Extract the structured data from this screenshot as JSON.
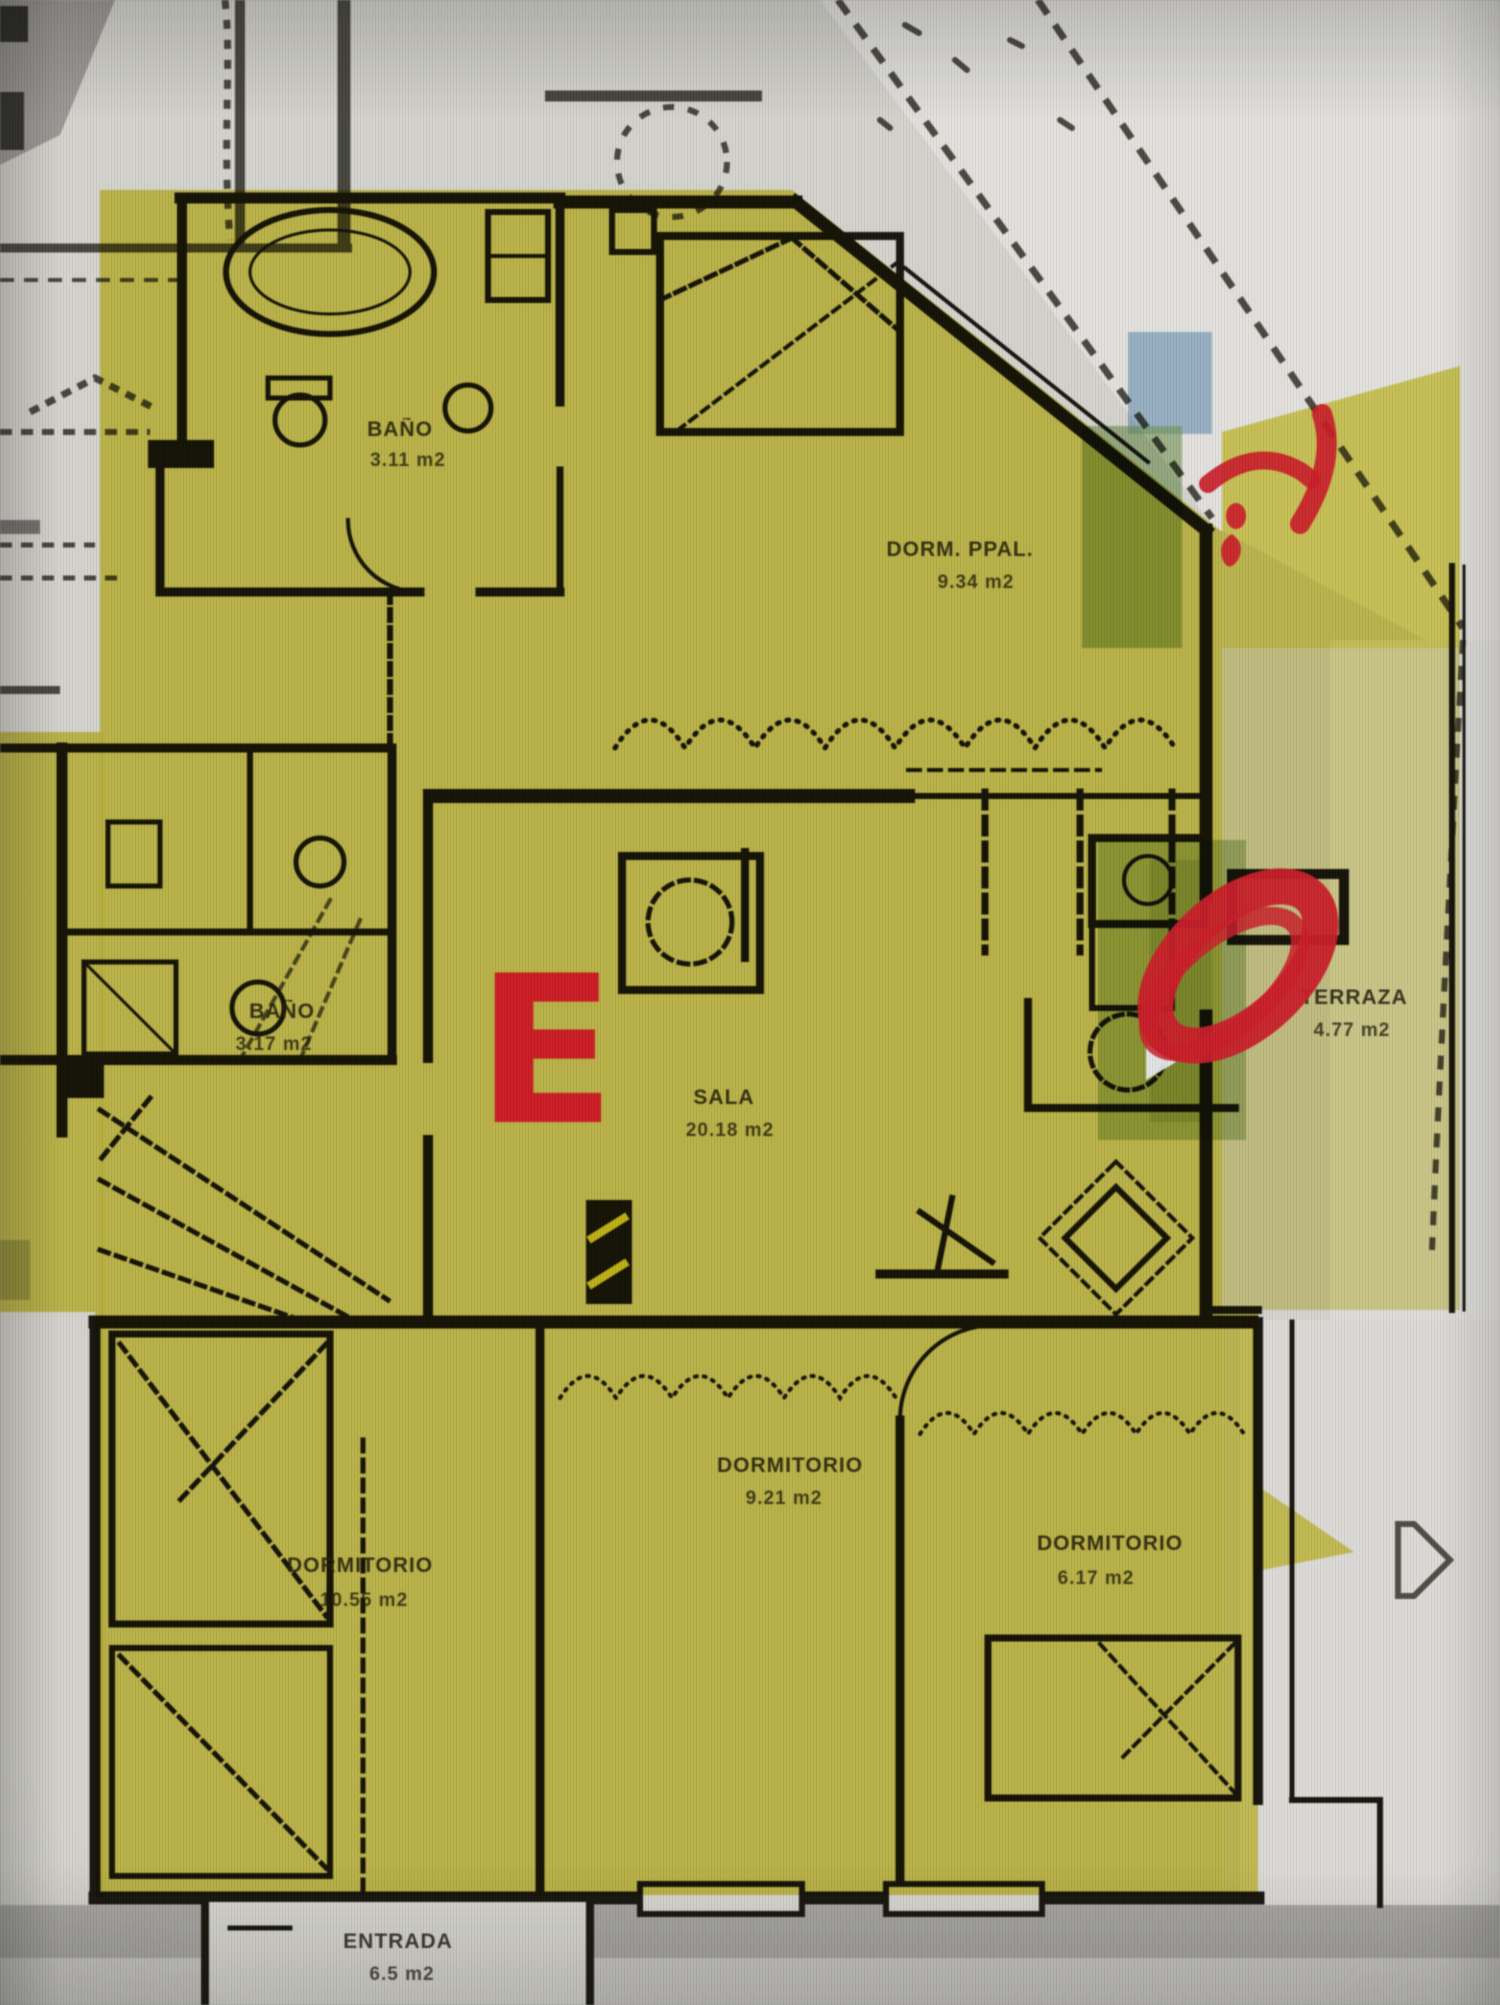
{
  "scene": {
    "description": "Photograph of an apartment floor plan highlighted in yellow marker with red unit letter and red pen annotations",
    "unit_letter": "E"
  },
  "palette": {
    "highlight_yellow": "#d9d24c",
    "terrace_yellow": "#d5cf63",
    "marker_red": "#c2202a",
    "letter_red": "#c41e25",
    "marker_green": "#7da45e",
    "marker_blue": "#7fa9cc",
    "paper": "#d7d6d1",
    "paper_bright": "#e4e3e0",
    "ink": "#17150e",
    "background_gray": "#b0afac"
  },
  "rooms": {
    "dorm_ppal": {
      "name": "DORM. PPAL.",
      "area": "9.34 m2"
    },
    "bano_1": {
      "name": "BAÑO",
      "area": "3.11 m2"
    },
    "bano_2": {
      "name": "BAÑO",
      "area": "3.17 m2"
    },
    "sala": {
      "name": "SALA",
      "area": "20.18 m2"
    },
    "terraza": {
      "name": "TERRAZA",
      "area": "4.77 m2"
    },
    "dormitorio_1": {
      "name": "DORMITORIO",
      "area": "10.55 m2"
    },
    "dormitorio_2": {
      "name": "DORMITORIO",
      "area": "9.21 m2"
    },
    "dormitorio_3": {
      "name": "DORMITORIO",
      "area": "6.17 m2"
    },
    "entrada": {
      "name": "ENTRADA",
      "area": "6.5 m2"
    }
  },
  "annotations": {
    "unit_letter": "E",
    "red_circle": "circled service door",
    "red_arrow": "arrow doodle at terrace corner"
  }
}
